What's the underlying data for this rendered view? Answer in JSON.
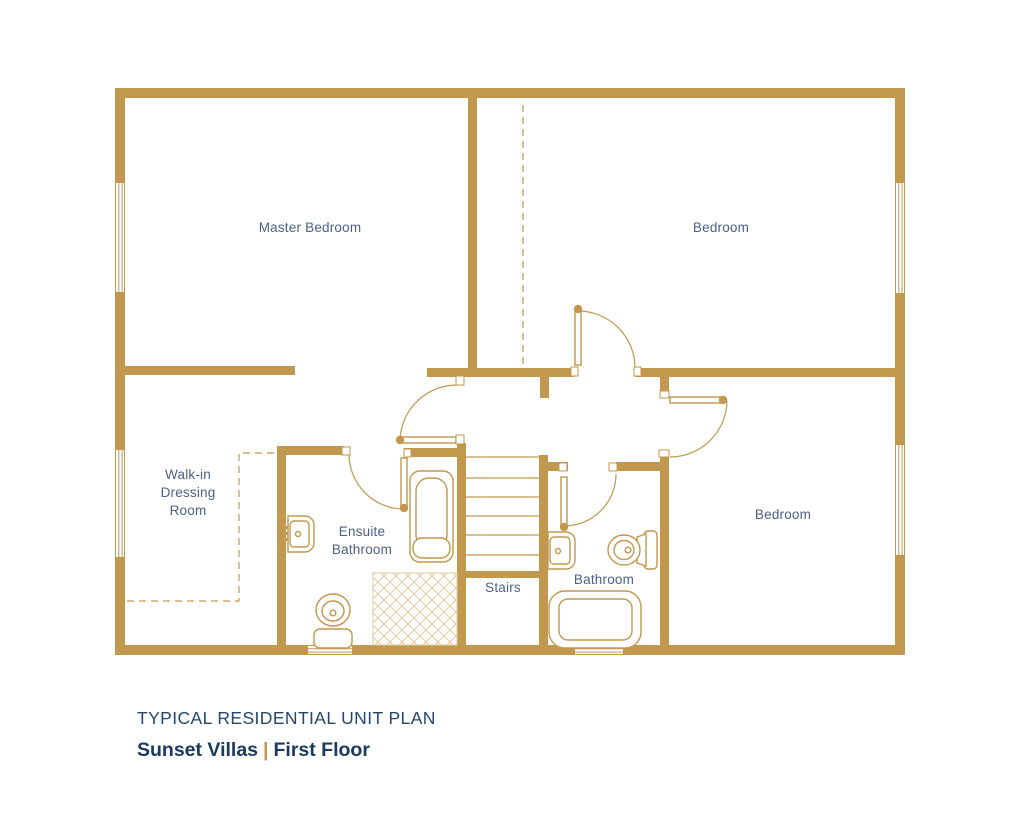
{
  "title": "TYPICAL RESIDENTIAL UNIT PLAN",
  "subtitle": {
    "project": "Sunset Villas",
    "separator": "|",
    "floor": "First Floor"
  },
  "rooms": {
    "master_bedroom": "Master Bedroom",
    "bedroom_top": "Bedroom",
    "bedroom_bottom": "Bedroom",
    "walk_in": "Walk-in\nDressing\nRoom",
    "ensuite": "Ensuite\nBathroom",
    "stairs": "Stairs",
    "bathroom": "Bathroom"
  },
  "colors": {
    "wall": "#C2974E",
    "wall_light": "#E2CBA0",
    "label": "#4D6088",
    "title": "#24476E",
    "subtitle": "#1A3A60",
    "separator": "#C2974E",
    "background": "#FFFFFF"
  }
}
